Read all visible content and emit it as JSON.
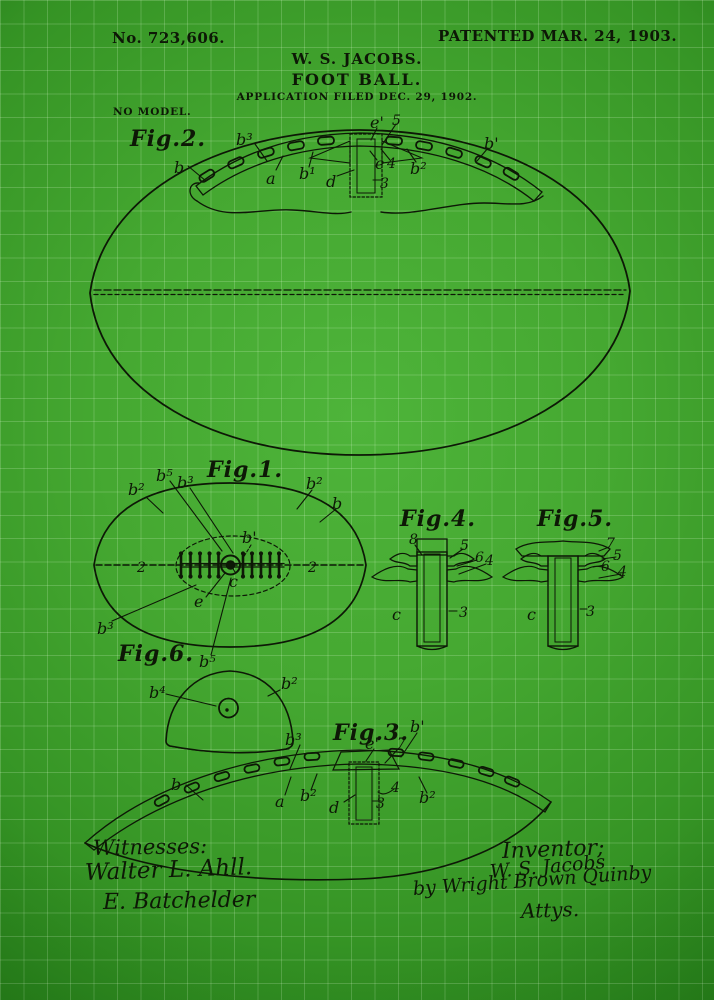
{
  "page": {
    "bg_center_color": "#4eb43a",
    "bg_edge_color": "#1b6c10",
    "grid_color": "rgba(230,255,220,0.20)",
    "ink_color": "#0d1806"
  },
  "header": {
    "patent_number": "No. 723,606.",
    "patent_date": "PATENTED MAR. 24, 1903.",
    "inventor_name": "W. S. JACOBS.",
    "invention_title": "FOOT BALL.",
    "application_line": "APPLICATION FILED DEC. 29, 1902.",
    "no_model": "NO MODEL."
  },
  "figures": {
    "fig1": {
      "title": "Fig.1.",
      "labels": {
        "b2_top_left": "b²",
        "b5_top": "b⁵",
        "b3_top": "b³",
        "b2_top_right": "b²",
        "b_right": "b",
        "b_prime": "b'",
        "c": "c",
        "e": "e",
        "two_left": "2",
        "two_right": "2",
        "b3_bottom": "b³",
        "b5_bottom": "b⁵"
      }
    },
    "fig2": {
      "title": "Fig.2.",
      "labels": {
        "b3": "b³",
        "b": "b",
        "a": "a",
        "b1": "b¹",
        "d": "d",
        "n3": "3",
        "e_prime": "e'",
        "n5": "5",
        "e": "e",
        "n4": "4",
        "b2": "b²",
        "b_prime": "b'"
      }
    },
    "fig3": {
      "title": "Fig.3.",
      "labels": {
        "b3": "b³",
        "e_prime": "e'",
        "n7": "7",
        "b_prime": "b'",
        "b": "b",
        "a": "a",
        "b2_left": "b²",
        "d": "d",
        "n3": "3",
        "n4": "4",
        "b2_right": "b²"
      }
    },
    "fig4": {
      "title": "Fig.4.",
      "labels": {
        "n8": "8",
        "n5": "5",
        "n6": "6",
        "n4": "4",
        "c": "c",
        "n3": "3"
      }
    },
    "fig5": {
      "title": "Fig.5.",
      "labels": {
        "n7": "7",
        "n5": "5",
        "n6": "6",
        "n4": "4",
        "c": "c",
        "n3": "3"
      }
    },
    "fig6": {
      "title": "Fig.6.",
      "labels": {
        "b4": "b⁴",
        "b2": "b²"
      }
    }
  },
  "footer": {
    "witnesses_heading": "Witnesses:",
    "witness1_signature": "Walter L. Ahll.",
    "witness2_signature": "E. Batchelder",
    "inventor_heading": "Inventor;",
    "inventor_signature": "W. S. Jacobs",
    "attorney_line": "by Wright Brown Quinby",
    "attorney_title": "Attys."
  }
}
